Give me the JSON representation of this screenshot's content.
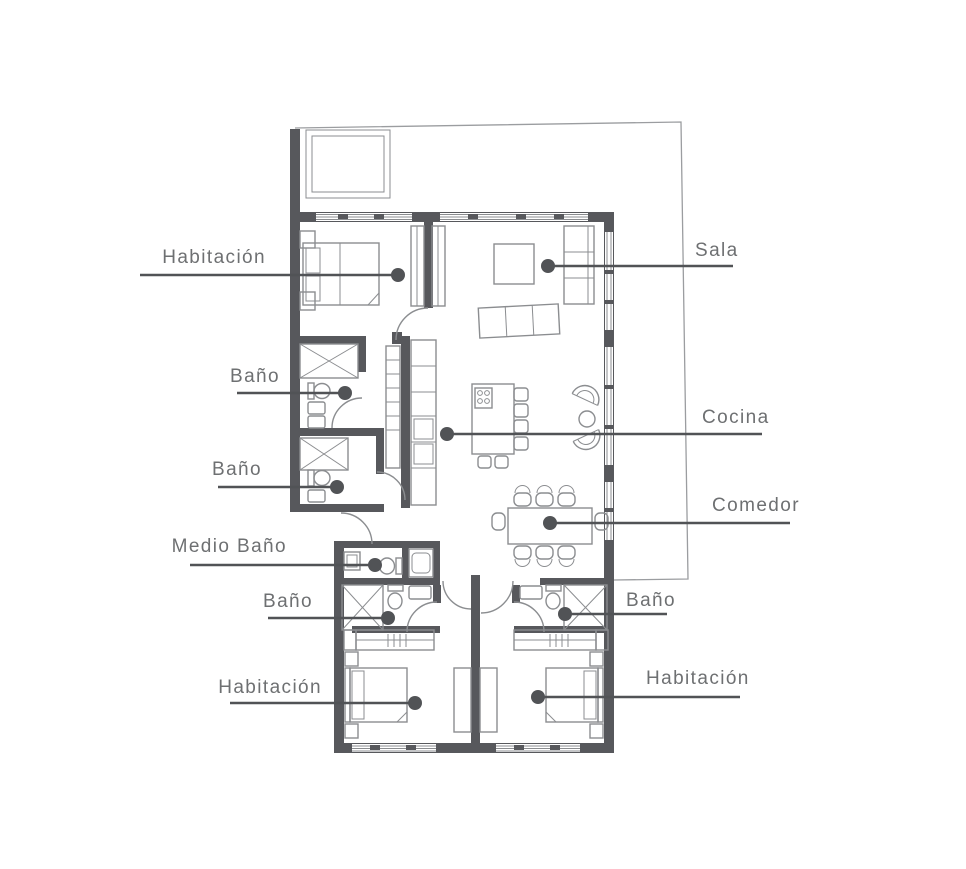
{
  "plan": {
    "labels": {
      "habitacion_1": "Habitación",
      "sala": "Sala",
      "bano_1": "Baño",
      "cocina": "Cocina",
      "bano_2": "Baño",
      "comedor": "Comedor",
      "medio_bano": "Medio Baño",
      "bano_3": "Baño",
      "bano_4": "Baño",
      "habitacion_2": "Habitación",
      "habitacion_3": "Habitación"
    },
    "colors": {
      "wall": "#57585c",
      "furniture_line": "#8b8d90",
      "terrace_line": "#9b9da0",
      "label_text": "#6e7072",
      "leader": "#515356",
      "background": "#ffffff"
    }
  }
}
